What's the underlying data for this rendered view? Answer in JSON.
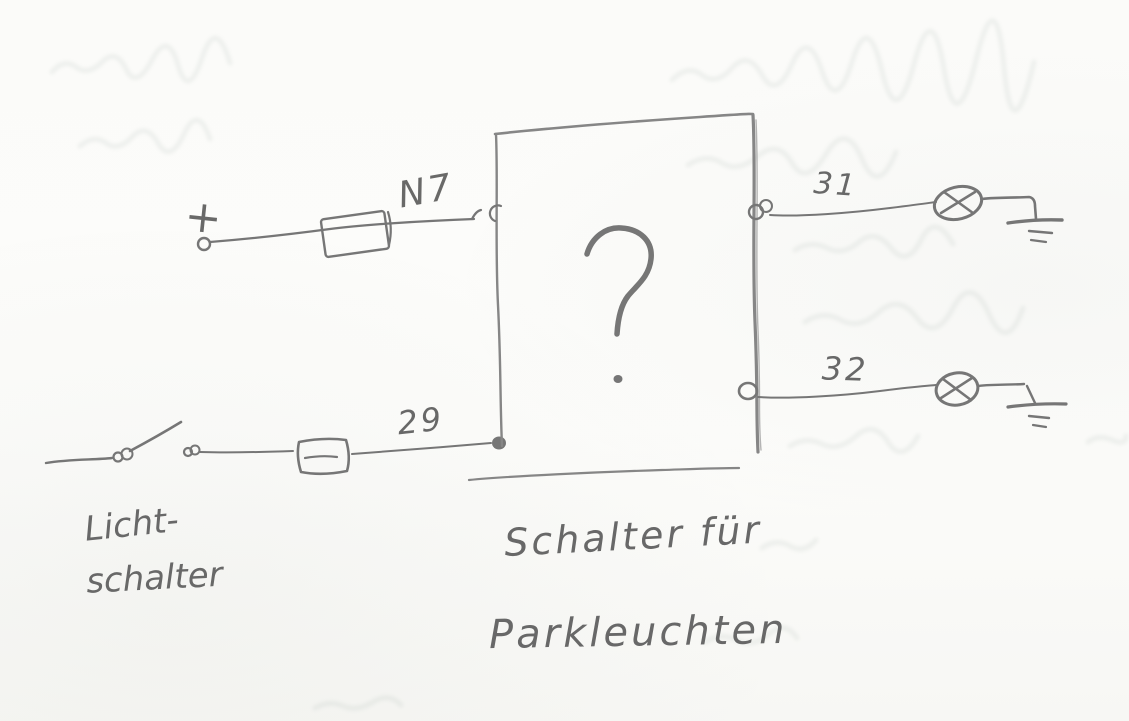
{
  "theme": {
    "paper_color": "#fbfbf9",
    "pencil_color": "#767676",
    "pencil_dark": "#555555",
    "pencil_box": "#868686",
    "ghost_color": "#93a39b"
  },
  "sketch": {
    "labels": {
      "plus": "+",
      "fuse_terminal": "N7",
      "switch_terminal": "29",
      "lamp_terminal_top": "31",
      "lamp_terminal_bottom": "32"
    },
    "box": {
      "unknown_mark": "?",
      "caption_line1": "Schalter für",
      "caption_line2": "Parkleuchten"
    },
    "switch_caption": {
      "line1": "Licht-",
      "line2": "schalter"
    },
    "symbols": [
      "plus-terminal",
      "fuse-symbol",
      "light-switch-symbol",
      "inline-connector-symbol",
      "unknown-device-box",
      "lamp-icon",
      "lamp-icon",
      "ground-icon",
      "ground-icon"
    ]
  }
}
